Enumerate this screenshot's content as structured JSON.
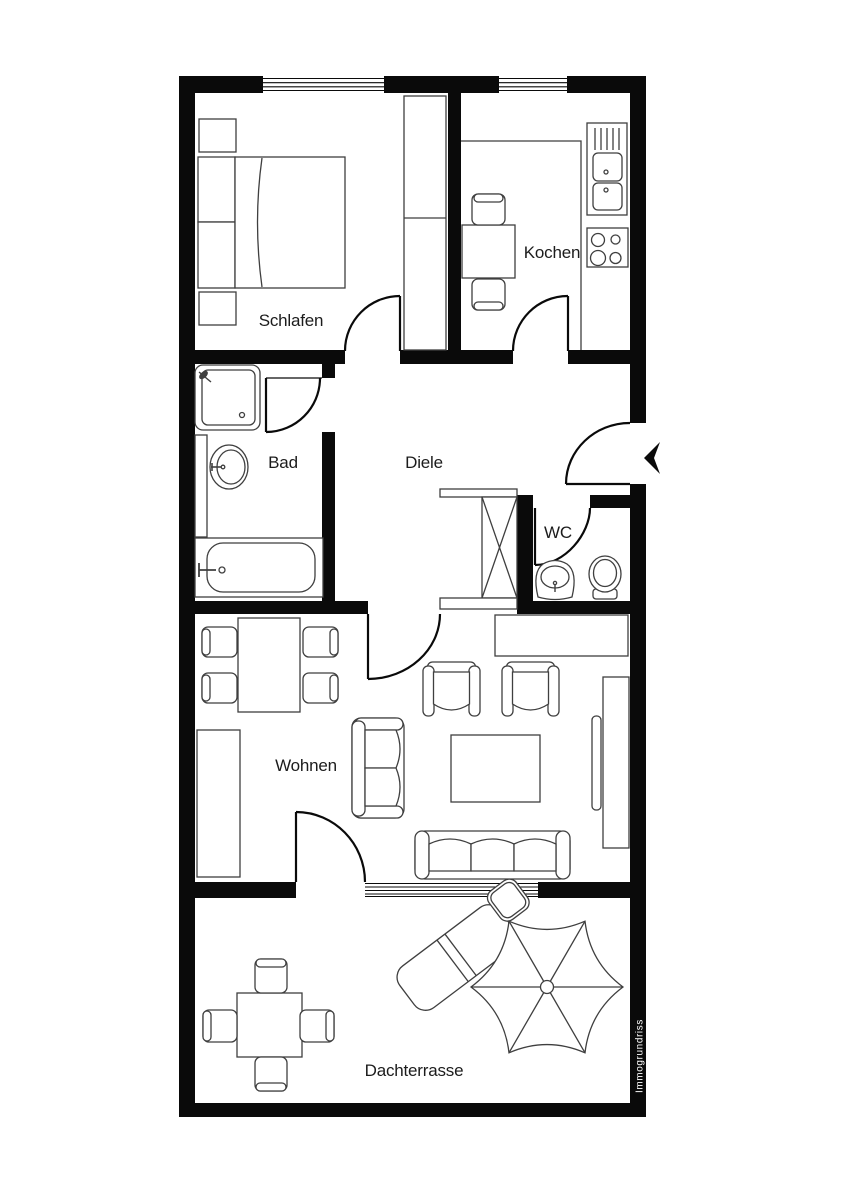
{
  "floorplan": {
    "rooms": {
      "schlafen": "Schlafen",
      "kochen": "Kochen",
      "bad": "Bad",
      "diele": "Diele",
      "wc": "WC",
      "wohnen": "Wohnen",
      "dachterrasse": "Dachterrasse"
    },
    "watermark": "Immogrundriss",
    "colors": {
      "wall": "#0a0a0a",
      "background": "#ffffff",
      "furniture_outline": "#3f3f3f",
      "label_text": "#1c1c1c",
      "watermark_text": "#ffffff"
    },
    "furniture": {
      "schlafen": [
        "double-bed",
        "nightstand",
        "nightstand",
        "wardrobe"
      ],
      "kochen": [
        "counter",
        "sink",
        "drainer",
        "stove",
        "table",
        "chair",
        "chair"
      ],
      "bad": [
        "shower",
        "washbasin",
        "bathtub"
      ],
      "wc": [
        "washbasin",
        "toilet"
      ],
      "diele": [
        "wardrobe"
      ],
      "wohnen": [
        "dining-table",
        "chairs",
        "sideboard",
        "loveseat",
        "armchair",
        "armchair",
        "coffee-table",
        "sofa",
        "tv-cabinet"
      ],
      "dachterrasse": [
        "table",
        "chairs",
        "sun-lounger",
        "parasol"
      ]
    }
  }
}
